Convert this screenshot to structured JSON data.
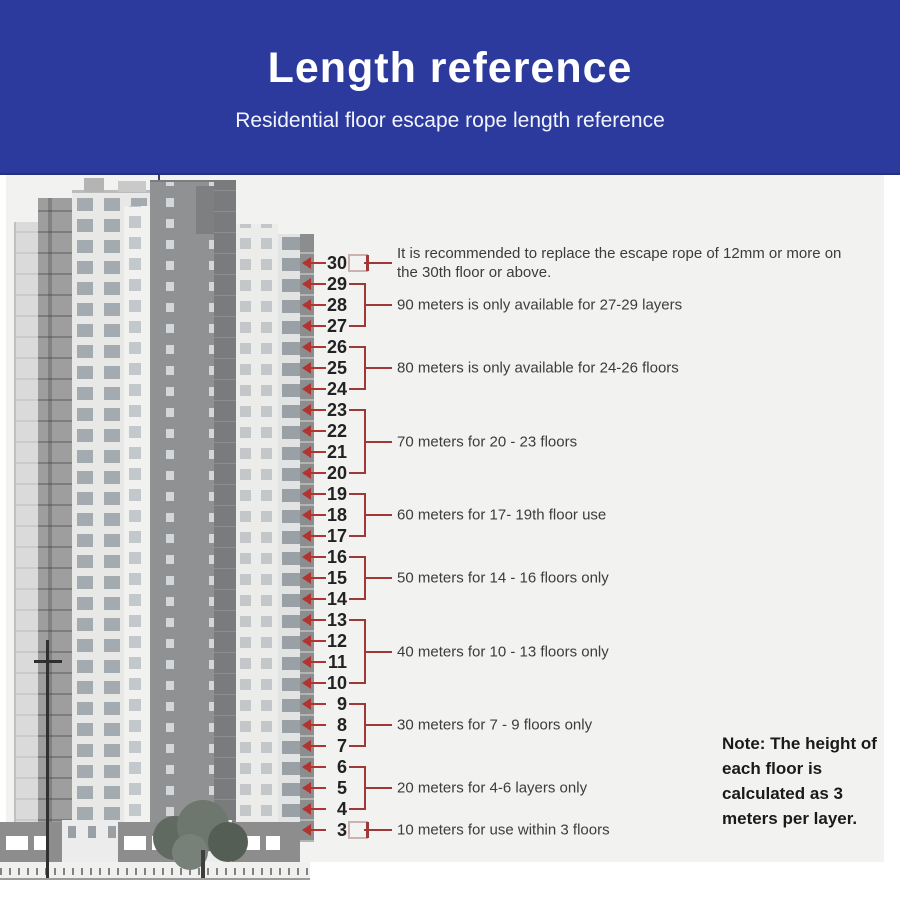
{
  "header": {
    "title": "Length reference",
    "subtitle": "Residential floor escape rope length reference",
    "bg_color": "#2b3a9c",
    "text_color": "#ffffff"
  },
  "diagram": {
    "floors": [
      30,
      29,
      28,
      27,
      26,
      25,
      24,
      23,
      22,
      21,
      20,
      19,
      18,
      17,
      16,
      15,
      14,
      13,
      12,
      11,
      10,
      9,
      8,
      7,
      6,
      5,
      4,
      3
    ],
    "annotations": [
      {
        "floors": "30",
        "top_floor": 30,
        "bottom_floor": 30,
        "label": "It is recommended to replace the escape rope of 12mm or more on the 30th floor or above."
      },
      {
        "floors": "27-29",
        "top_floor": 29,
        "bottom_floor": 27,
        "label": "90 meters is only available for 27-29 layers"
      },
      {
        "floors": "24-26",
        "top_floor": 26,
        "bottom_floor": 24,
        "label": "80 meters is only available for 24-26 floors"
      },
      {
        "floors": "20-23",
        "top_floor": 23,
        "bottom_floor": 20,
        "label": "70 meters for 20 - 23 floors"
      },
      {
        "floors": "17-19",
        "top_floor": 19,
        "bottom_floor": 17,
        "label": "60 meters for 17- 19th floor use"
      },
      {
        "floors": "14-16",
        "top_floor": 16,
        "bottom_floor": 14,
        "label": "50 meters for 14 - 16 floors only"
      },
      {
        "floors": "10-13",
        "top_floor": 13,
        "bottom_floor": 10,
        "label": "40 meters for 10 - 13 floors only"
      },
      {
        "floors": "7-9",
        "top_floor": 9,
        "bottom_floor": 7,
        "label": "30 meters for 7 - 9 floors only"
      },
      {
        "floors": "4-6",
        "top_floor": 6,
        "bottom_floor": 4,
        "label": "20 meters for 4-6 layers only"
      },
      {
        "floors": "3",
        "top_floor": 3,
        "bottom_floor": 3,
        "label": "10 meters for use within 3 floors"
      }
    ],
    "line_color": "#9e3937",
    "arrow_color": "#b23430"
  },
  "note": {
    "text": "Note: The height of each floor is calculated as 3 meters per layer."
  },
  "building": {
    "description": "grayscale residential high-rise towers with street-level shops and a tree"
  }
}
